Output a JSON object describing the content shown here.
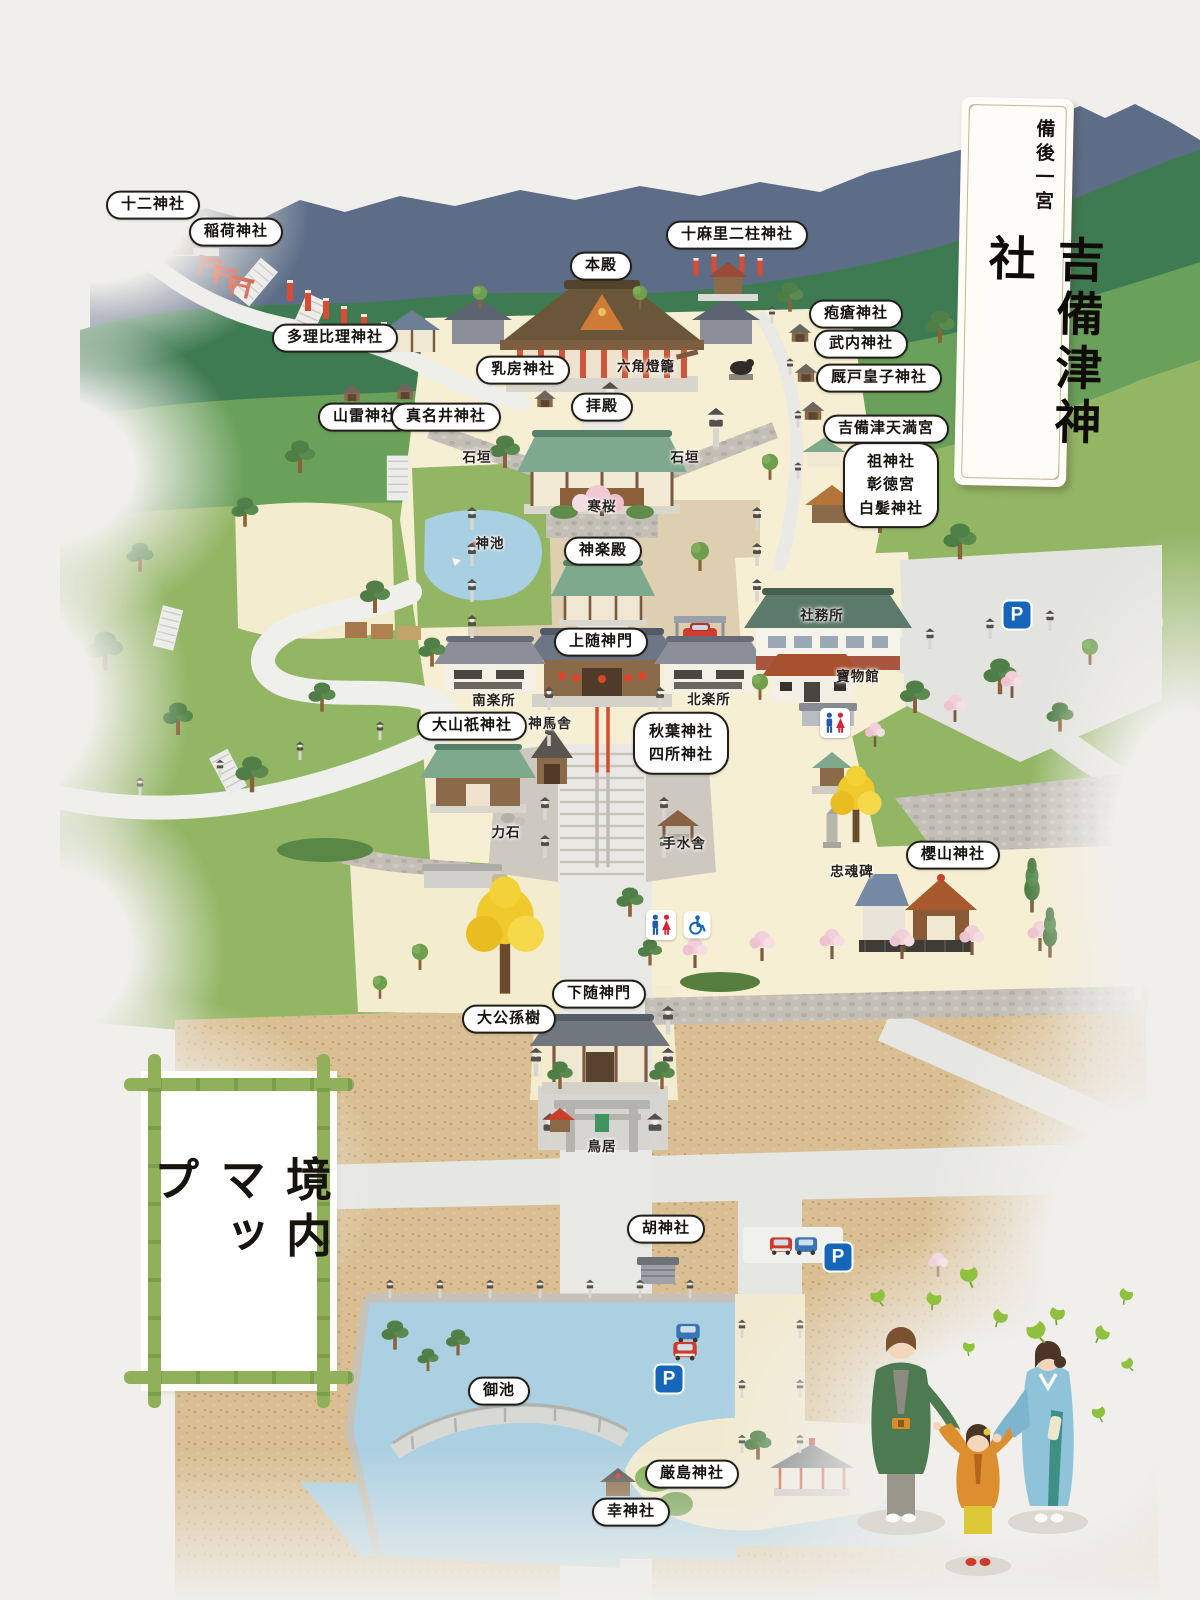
{
  "title_card": {
    "region": "備後一宮",
    "name": "吉備津神社"
  },
  "map_frame_title": "境内マップ",
  "colors": {
    "background": "#f0efeb",
    "mountain": "#5d6d87",
    "ridge_green": "#3f7b52",
    "grass": "#93b665",
    "courtyard_cream": "#f6efd3",
    "sand": "#d9bf93",
    "water": "#aacfe1",
    "vermilion": "#d9472b",
    "bamboo_green": "#90b05a",
    "bubble_border": "#211d18",
    "parking_blue": "#1565b8",
    "restroom_blue": "#2458a8",
    "restroom_red": "#d6243c"
  },
  "labels_bubble": [
    {
      "text": "十二神社",
      "x": 153,
      "y": 205
    },
    {
      "text": "稲荷神社",
      "x": 236,
      "y": 232
    },
    {
      "text": "多理比理神社",
      "x": 335,
      "y": 338
    },
    {
      "text": "山雷神社",
      "x": 365,
      "y": 417
    },
    {
      "text": "真名井神社",
      "x": 446,
      "y": 417
    },
    {
      "text": "乳房神社",
      "x": 523,
      "y": 370
    },
    {
      "text": "本殿",
      "x": 601,
      "y": 266
    },
    {
      "text": "十麻里二柱神社",
      "x": 737,
      "y": 235
    },
    {
      "text": "疱瘡神社",
      "x": 856,
      "y": 314
    },
    {
      "text": "武内神社",
      "x": 861,
      "y": 344
    },
    {
      "text": "厩戸皇子神社",
      "x": 879,
      "y": 378
    },
    {
      "text": "吉備津天満宮",
      "x": 886,
      "y": 429
    },
    {
      "lines": [
        "祖神社",
        "彰徳宮",
        "白髪神社"
      ],
      "x": 891,
      "y": 485
    },
    {
      "text": "拝殿",
      "x": 602,
      "y": 407
    },
    {
      "text": "神楽殿",
      "x": 603,
      "y": 551
    },
    {
      "text": "上随神門",
      "x": 601,
      "y": 642
    },
    {
      "text": "大山祇神社",
      "x": 472,
      "y": 726
    },
    {
      "lines": [
        "秋葉神社",
        "四所神社"
      ],
      "x": 681,
      "y": 743
    },
    {
      "text": "櫻山神社",
      "x": 953,
      "y": 855
    },
    {
      "text": "下随神門",
      "x": 599,
      "y": 994
    },
    {
      "text": "大公孫樹",
      "x": 509,
      "y": 1019
    },
    {
      "text": "胡神社",
      "x": 666,
      "y": 1229
    },
    {
      "text": "御池",
      "x": 499,
      "y": 1391
    },
    {
      "text": "厳島神社",
      "x": 692,
      "y": 1474
    },
    {
      "text": "幸神社",
      "x": 631,
      "y": 1512
    }
  ],
  "labels_plain": [
    {
      "text": "六角燈籠",
      "x": 646,
      "y": 365
    },
    {
      "text": "石垣",
      "x": 477,
      "y": 456
    },
    {
      "text": "石垣",
      "x": 685,
      "y": 456
    },
    {
      "text": "寒桜",
      "x": 602,
      "y": 505
    },
    {
      "text": "神池",
      "x": 490,
      "y": 542
    },
    {
      "text": "社務所",
      "x": 822,
      "y": 614
    },
    {
      "text": "寶物館",
      "x": 858,
      "y": 675
    },
    {
      "text": "南楽所",
      "x": 494,
      "y": 699
    },
    {
      "text": "北楽所",
      "x": 709,
      "y": 698
    },
    {
      "text": "神馬舎",
      "x": 550,
      "y": 722
    },
    {
      "text": "力石",
      "x": 506,
      "y": 831
    },
    {
      "text": "手水舎",
      "x": 684,
      "y": 842
    },
    {
      "text": "忠魂碑",
      "x": 852,
      "y": 870
    },
    {
      "text": "鳥居",
      "x": 602,
      "y": 1145
    }
  ],
  "icons": {
    "parking_letter": "P",
    "markers": {
      "parking": [
        {
          "x": 1017,
          "y": 615
        },
        {
          "x": 838,
          "y": 1257
        },
        {
          "x": 669,
          "y": 1379
        }
      ],
      "restroom": [
        {
          "x": 835,
          "y": 723
        },
        {
          "x": 661,
          "y": 925
        }
      ],
      "accessible": [
        {
          "x": 697,
          "y": 925
        }
      ]
    }
  }
}
